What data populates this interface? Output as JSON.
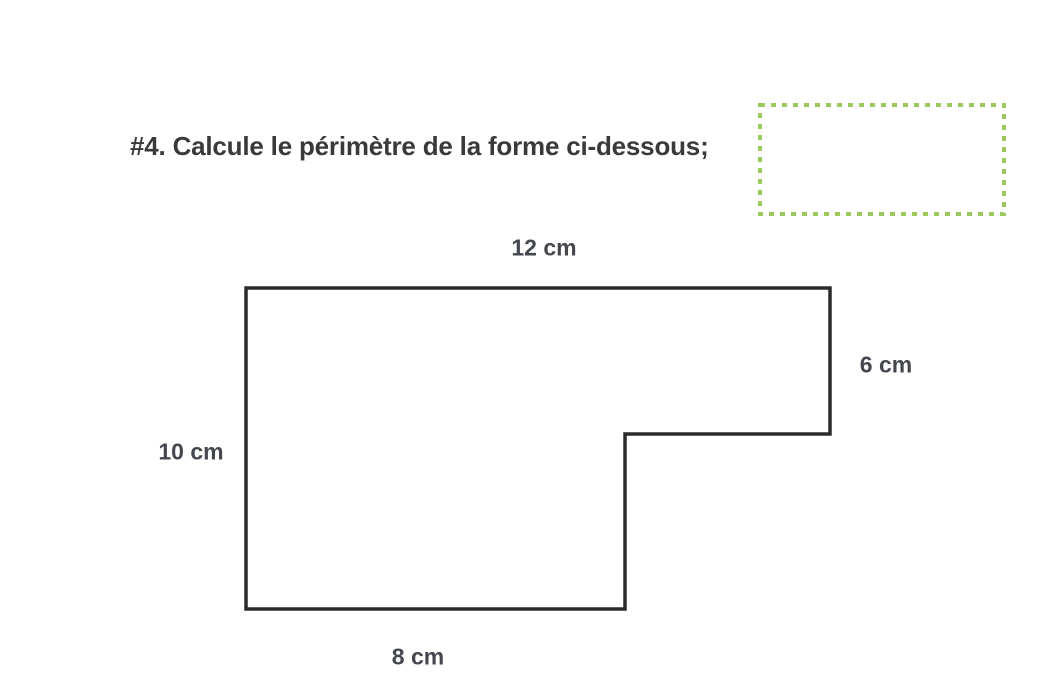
{
  "page": {
    "background_color": "#ffffff"
  },
  "problem": {
    "title": "#4. Calcule le périmètre de la forme ci-dessous;"
  },
  "answer_box": {
    "border_color": "#9cc95e"
  },
  "figure": {
    "type": "l-shape-polygon",
    "stroke_color": "#2b2b2b",
    "labels": {
      "top": "12 cm",
      "right": "6 cm",
      "left": "10 cm",
      "bottom": "8 cm"
    }
  }
}
